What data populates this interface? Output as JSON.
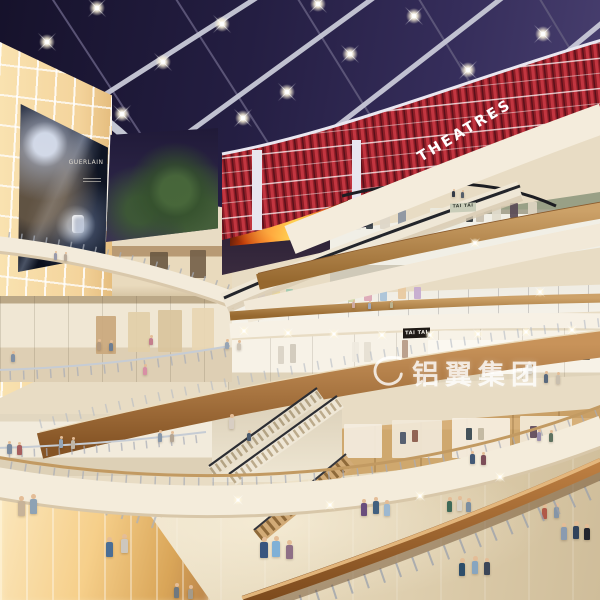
{
  "meta": {
    "description": "Interior rendering of a multi-level shopping mall atrium with purple skylight grid, red-slatted cinema level, sweeping white balconies, escalators and shoppers"
  },
  "signs": {
    "theatres": "THEATRES",
    "upper_shop": "TAI TAI",
    "lower_shop": "TAI TAI",
    "billboard_brand": "GUERLAIN",
    "watermark": "铝翼集团"
  },
  "colors": {
    "sky": "#241e42",
    "beam": "#c9cad8",
    "theatre_red": "#a32430",
    "fascia_cream": "#f4ecdc",
    "cove_glow": "#ffe9bd",
    "wood": "#b9854a",
    "floor_beige": "#e7dcc6",
    "backlit_panel": "#f5d9a8",
    "led_fire": "#ff7a1e",
    "watermark_white": "rgba(255,255,255,0.8)"
  },
  "ceiling_lights": [
    [
      47,
      42
    ],
    [
      97,
      8
    ],
    [
      163,
      62
    ],
    [
      222,
      24
    ],
    [
      287,
      92
    ],
    [
      350,
      54
    ],
    [
      414,
      16
    ],
    [
      468,
      70
    ],
    [
      543,
      34
    ],
    [
      586,
      74
    ],
    [
      122,
      114
    ],
    [
      243,
      118
    ],
    [
      318,
      4
    ]
  ],
  "fascia_sparkles": [
    [
      244,
      331
    ],
    [
      288,
      333
    ],
    [
      334,
      334
    ],
    [
      382,
      335
    ],
    [
      430,
      335
    ],
    [
      478,
      334
    ],
    [
      526,
      332
    ],
    [
      572,
      330
    ],
    [
      540,
      292
    ],
    [
      475,
      243
    ],
    [
      238,
      500
    ],
    [
      330,
      505
    ],
    [
      420,
      496
    ],
    [
      500,
      477
    ]
  ],
  "people": [
    [
      106,
      537,
      20,
      "#4a6e95"
    ],
    [
      121,
      534,
      19,
      "#cdc7bd"
    ],
    [
      260,
      537,
      21,
      "#39557f"
    ],
    [
      272,
      536,
      21,
      "#7fb0d6"
    ],
    [
      286,
      540,
      19,
      "#8e6f86"
    ],
    [
      361,
      499,
      17,
      "#6a4e7d"
    ],
    [
      373,
      497,
      17,
      "#41607f"
    ],
    [
      384,
      500,
      16,
      "#9db8d0"
    ],
    [
      447,
      497,
      15,
      "#3e6a58"
    ],
    [
      457,
      496,
      15,
      "#d9d3c8"
    ],
    [
      466,
      498,
      14,
      "#7b8ea0"
    ],
    [
      542,
      504,
      15,
      "#b05948"
    ],
    [
      554,
      503,
      15,
      "#8595a6"
    ],
    [
      459,
      558,
      18,
      "#2e4e6a"
    ],
    [
      472,
      556,
      18,
      "#87a5bf"
    ],
    [
      484,
      558,
      17,
      "#3c4658"
    ],
    [
      561,
      523,
      17,
      "#8a9bb0"
    ],
    [
      573,
      521,
      18,
      "#32435b"
    ],
    [
      584,
      524,
      16,
      "#23252e"
    ],
    [
      174,
      583,
      15,
      "#70787f"
    ],
    [
      188,
      585,
      14,
      "#a39a8a"
    ],
    [
      18,
      496,
      20,
      "#c7b399"
    ],
    [
      30,
      494,
      20,
      "#8ea2b4"
    ],
    [
      7,
      441,
      13,
      "#7c8ca0"
    ],
    [
      17,
      442,
      13,
      "#a75e5e"
    ],
    [
      59,
      436,
      12,
      "#95a6b7"
    ],
    [
      71,
      437,
      12,
      "#bfb5a5"
    ],
    [
      158,
      430,
      12,
      "#8797a9"
    ],
    [
      170,
      431,
      11,
      "#b4a593"
    ],
    [
      470,
      451,
      13,
      "#435976"
    ],
    [
      481,
      452,
      13,
      "#7d4e59"
    ],
    [
      537,
      429,
      12,
      "#9a8ead"
    ],
    [
      549,
      430,
      12,
      "#5e7260"
    ],
    [
      229,
      414,
      15,
      "#d8cec3"
    ],
    [
      247,
      430,
      11,
      "#4a5a6e"
    ],
    [
      11,
      351,
      11,
      "#8090a4"
    ],
    [
      97,
      339,
      11,
      "#b3997d"
    ],
    [
      109,
      340,
      11,
      "#6e7e92"
    ],
    [
      149,
      335,
      10,
      "#c47e8d"
    ],
    [
      225,
      339,
      10,
      "#96a4b4"
    ],
    [
      237,
      340,
      10,
      "#cec5b7"
    ],
    [
      143,
      364,
      11,
      "#d88fa5"
    ],
    [
      527,
      361,
      13,
      "#d7d2c7"
    ],
    [
      544,
      371,
      12,
      "#59697d"
    ],
    [
      556,
      372,
      12,
      "#c8beae"
    ],
    [
      54,
      251,
      9,
      "#9899aa"
    ],
    [
      64,
      252,
      9,
      "#b9aa9a"
    ],
    [
      452,
      189,
      8,
      "#333a46"
    ],
    [
      461,
      190,
      8,
      "#555e6a"
    ],
    [
      352,
      300,
      8,
      "#cfaaa0"
    ],
    [
      368,
      301,
      8,
      "#a0a9bb"
    ],
    [
      390,
      300,
      8,
      "#bbb390"
    ]
  ],
  "accents": [
    [
      340,
      214,
      8,
      16,
      "#b8454f"
    ],
    [
      352,
      212,
      9,
      18,
      "#e8e5dc"
    ],
    [
      366,
      213,
      7,
      16,
      "#3a4148"
    ],
    [
      380,
      211,
      10,
      18,
      "#ddd6c8"
    ],
    [
      398,
      210,
      8,
      17,
      "#8a93a0"
    ],
    [
      430,
      208,
      30,
      20,
      "#eceadf"
    ],
    [
      466,
      207,
      7,
      15,
      "#2e3338"
    ],
    [
      476,
      206,
      8,
      16,
      "#c8beac"
    ],
    [
      492,
      205,
      9,
      16,
      "#e2dccd"
    ],
    [
      510,
      203,
      8,
      15,
      "#5a4a56"
    ],
    [
      528,
      202,
      9,
      15,
      "#ded5c2"
    ],
    [
      246,
      292,
      8,
      13,
      "#d98da0"
    ],
    [
      258,
      290,
      7,
      14,
      "#c9c2e8"
    ],
    [
      272,
      291,
      8,
      12,
      "#e8d598"
    ],
    [
      286,
      289,
      7,
      14,
      "#9ec9b0"
    ],
    [
      300,
      290,
      8,
      12,
      "#d9a98a"
    ],
    [
      316,
      289,
      7,
      14,
      "#b5cade"
    ],
    [
      332,
      290,
      8,
      12,
      "#e5b8c8"
    ],
    [
      348,
      289,
      7,
      13,
      "#cfd8a8"
    ],
    [
      364,
      288,
      8,
      13,
      "#dca6b5"
    ],
    [
      380,
      288,
      7,
      13,
      "#a9c2d8"
    ],
    [
      398,
      287,
      8,
      12,
      "#e8c9a0"
    ],
    [
      414,
      287,
      7,
      12,
      "#c4a9cf"
    ],
    [
      428,
      340,
      86,
      34,
      "#fbf8f1"
    ],
    [
      278,
      346,
      6,
      18,
      "#d9d3c6"
    ],
    [
      290,
      344,
      6,
      19,
      "#cfc9bb"
    ],
    [
      352,
      342,
      7,
      20,
      "#efeae0"
    ],
    [
      364,
      342,
      7,
      20,
      "#e5dfd2"
    ],
    [
      402,
      340,
      6,
      18,
      "#b59a85"
    ],
    [
      548,
      342,
      10,
      17,
      "#2a2522"
    ],
    [
      562,
      342,
      9,
      17,
      "#3a332c"
    ],
    [
      582,
      344,
      8,
      16,
      "#60584c"
    ],
    [
      344,
      424,
      38,
      34,
      "#f4ede0"
    ],
    [
      392,
      420,
      50,
      38,
      "#f1e8d8"
    ],
    [
      452,
      418,
      58,
      40,
      "#f6efe2"
    ],
    [
      520,
      416,
      52,
      40,
      "#f2e9d8"
    ],
    [
      400,
      432,
      6,
      12,
      "#4a5568"
    ],
    [
      412,
      430,
      6,
      12,
      "#8a5a4a"
    ],
    [
      466,
      428,
      6,
      12,
      "#35444f"
    ],
    [
      478,
      428,
      6,
      12,
      "#c0b5a0"
    ],
    [
      530,
      426,
      7,
      12,
      "#5f4a5a"
    ],
    [
      96,
      316,
      20,
      38,
      "#caa87c"
    ],
    [
      128,
      312,
      22,
      40,
      "#e2cfa8"
    ],
    [
      158,
      310,
      24,
      42,
      "#d9c49c"
    ],
    [
      192,
      308,
      22,
      42,
      "#e8d6b2"
    ],
    [
      150,
      252,
      18,
      26,
      "#6b5a43"
    ],
    [
      190,
      250,
      16,
      28,
      "#75624a"
    ]
  ]
}
